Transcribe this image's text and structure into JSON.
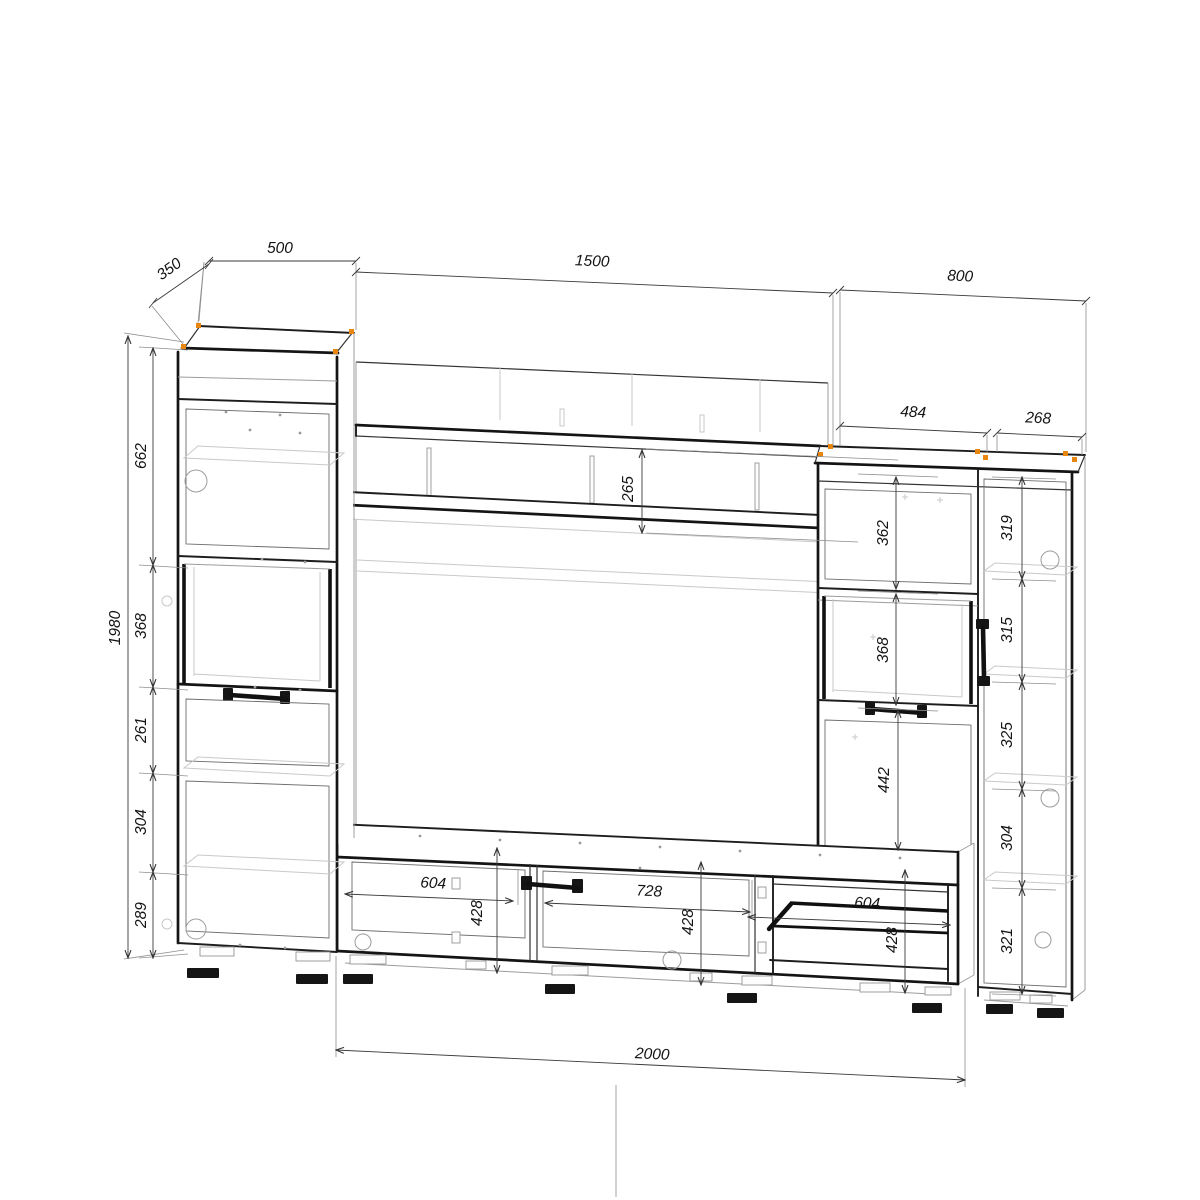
{
  "title": "СХЕМА ИЗДЕЛИЯ",
  "colors": {
    "background": "#ffffff",
    "outline_black": "#141414",
    "detail_gray": "#9c9c9c",
    "title_gray": "#8d8d8d",
    "accent_orange": "#e8860f"
  },
  "dims": {
    "cabinet_left": {
      "depth": "350",
      "width": "500",
      "height": "1980",
      "sections": [
        "662",
        "368",
        "261",
        "304",
        "289"
      ]
    },
    "center": {
      "width": "1500",
      "shelf_gap": "265"
    },
    "cabinet_right": {
      "width": "800",
      "door_width": "484",
      "side_width": "268",
      "door_sections": [
        "362",
        "368",
        "442"
      ],
      "side_sections": [
        "319",
        "315",
        "325",
        "304",
        "321"
      ]
    },
    "stand": {
      "width": "2000",
      "left": {
        "w": "604",
        "h": "428"
      },
      "middle": {
        "w": "728",
        "h": "428"
      },
      "niche": {
        "w": "604",
        "h": "428"
      }
    }
  }
}
